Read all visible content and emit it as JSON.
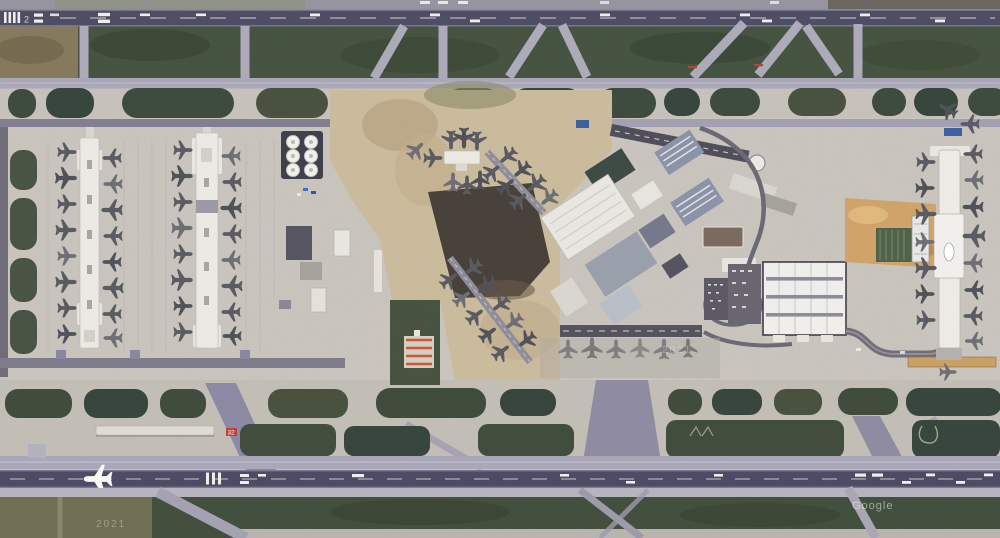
{
  "scene": {
    "type": "satellite-aerial-imagery",
    "subject": "midfield view of a large international airport",
    "layout": "two parallel east-west runways at top and bottom, taxiway network and grass infields, west apron with two linear concourses, central terminal complex with diagonal piers, white ribbed terminal hall and a north-south concourse on the east side, fuel tank farm and construction zones"
  },
  "labels": {
    "watermark_provider": "Google",
    "imagery_year_sw": "2021",
    "imagery_year_center": "2021",
    "runway_designator": "2",
    "taxiway_sign": "32"
  },
  "objects": {
    "fuel_tanks": 6,
    "linear_concourses": 3,
    "remote_pier": 1,
    "diagonal_piers": 2,
    "aircraft_at_gates_approx": 78,
    "aircraft_on_runway": 1
  },
  "palette": {
    "runway": "#4e4c63",
    "taxiway_light": "#a9a6b8",
    "taxiway_mid": "#8d89a4",
    "concrete_apron": "#c8c4bc",
    "grass_dark": "#3d4b3b",
    "grass_olive": "#6f6e52",
    "field_brown": "#84795d",
    "dirt_tan": "#cbbb9d",
    "dirt_orange": "#d0a368",
    "building_white": "#edebe4",
    "charcoal_apron": "#474039",
    "aircraft_gray": "#595a61"
  }
}
